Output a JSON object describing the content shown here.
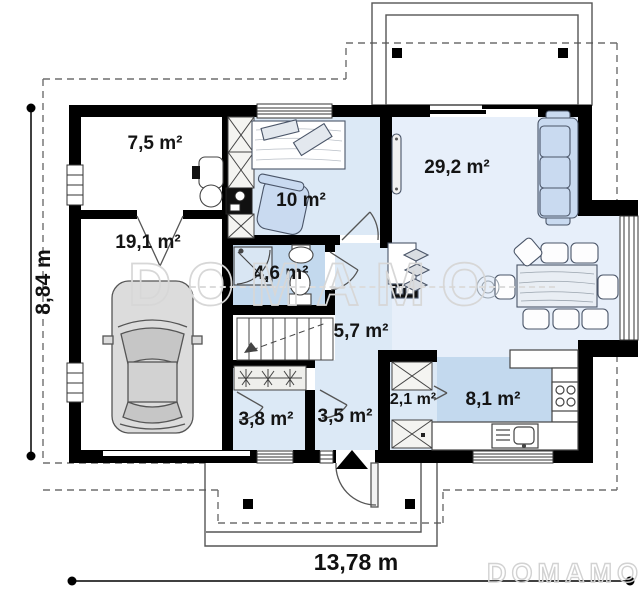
{
  "watermark": {
    "center": "DOMAMO",
    "corner": "DOMAMO"
  },
  "dimensions": {
    "width": "13,78 m",
    "height": "8,84 m"
  },
  "rooms": [
    {
      "id": "utility-room",
      "area": "7,5 m²"
    },
    {
      "id": "garage",
      "area": "19,1 m²"
    },
    {
      "id": "office",
      "area": "10 m²"
    },
    {
      "id": "bathroom",
      "area": "4,6 m²"
    },
    {
      "id": "living-room",
      "area": "29,2 m²"
    },
    {
      "id": "hall",
      "area": "5,7 m²"
    },
    {
      "id": "wardrobe",
      "area": "3,8 m²"
    },
    {
      "id": "vestibule",
      "area": "3,5 m²"
    },
    {
      "id": "pantry",
      "area": "2,1 m²"
    },
    {
      "id": "kitchen",
      "area": "8,1 m²"
    }
  ]
}
